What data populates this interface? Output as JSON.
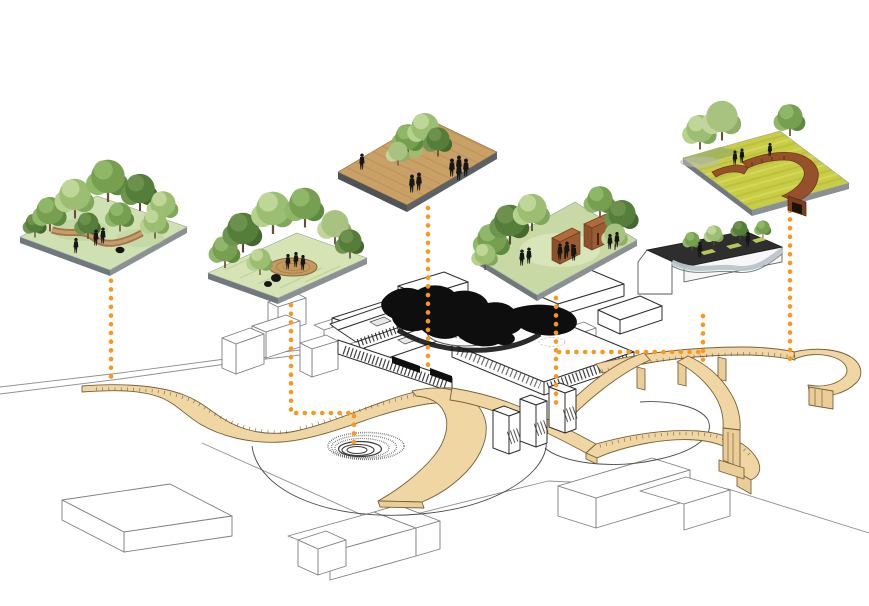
{
  "canvas": {
    "width": 869,
    "height": 606,
    "background": "#FFFFFF"
  },
  "colors": {
    "accent_orange": "#F8991D",
    "path_tan": "#F0D6A3",
    "path_outline": "#77613C",
    "building_line": "#2E2E2E",
    "black_roof": "#0E0E0E",
    "spiral_gray": "#3C3C3C",
    "corten_brown": "#96512C",
    "deck_wood": "#C59A5F",
    "field_yellow": "#C9CD45",
    "grass_green": "#CFE0B3",
    "tree_green": "#76A050",
    "figure_black": "#161616",
    "roof_deck_dark": "#2E2E2E",
    "parapet_blue_gray": "#B9C6C9"
  },
  "vignettes": [
    {
      "id": "v1",
      "name": "forest-walk-garden"
    },
    {
      "id": "v2",
      "name": "meadow-deck-garden"
    },
    {
      "id": "v3",
      "name": "timber-plaza"
    },
    {
      "id": "v4",
      "name": "courtyard-pavilions-garden"
    },
    {
      "id": "v5",
      "name": "meadow-corten-ramp"
    },
    {
      "id": "v6",
      "name": "rooftop-garden"
    }
  ],
  "connectors": [
    {
      "name": "connector-forest-walk",
      "points": [
        [
          111,
          272
        ],
        [
          111,
          384
        ]
      ]
    },
    {
      "name": "connector-meadow-deck",
      "points": [
        [
          291,
          305
        ],
        [
          291,
          413
        ],
        [
          354,
          413
        ],
        [
          354,
          449
        ]
      ]
    },
    {
      "name": "connector-timber-plaza",
      "points": [
        [
          428,
          208
        ],
        [
          428,
          369
        ]
      ]
    },
    {
      "name": "connector-courtyard-pavilions",
      "points": [
        [
          556,
          298
        ],
        [
          556,
          406
        ]
      ]
    },
    {
      "name": "connector-meadow-ramp",
      "points": [
        [
          790,
          202
        ],
        [
          790,
          367
        ]
      ]
    },
    {
      "name": "connector-rooftop-garden",
      "points": [
        [
          703,
          316
        ],
        [
          703,
          366
        ]
      ]
    },
    {
      "name": "connector-cross-link",
      "points": [
        [
          559,
          352
        ],
        [
          700,
          352
        ]
      ]
    }
  ],
  "site": {
    "features": [
      "main-building",
      "spiral-amphitheater",
      "looping-ground-path",
      "elevated-walkway",
      "tower-volumes",
      "context-buildings",
      "access-road"
    ]
  }
}
